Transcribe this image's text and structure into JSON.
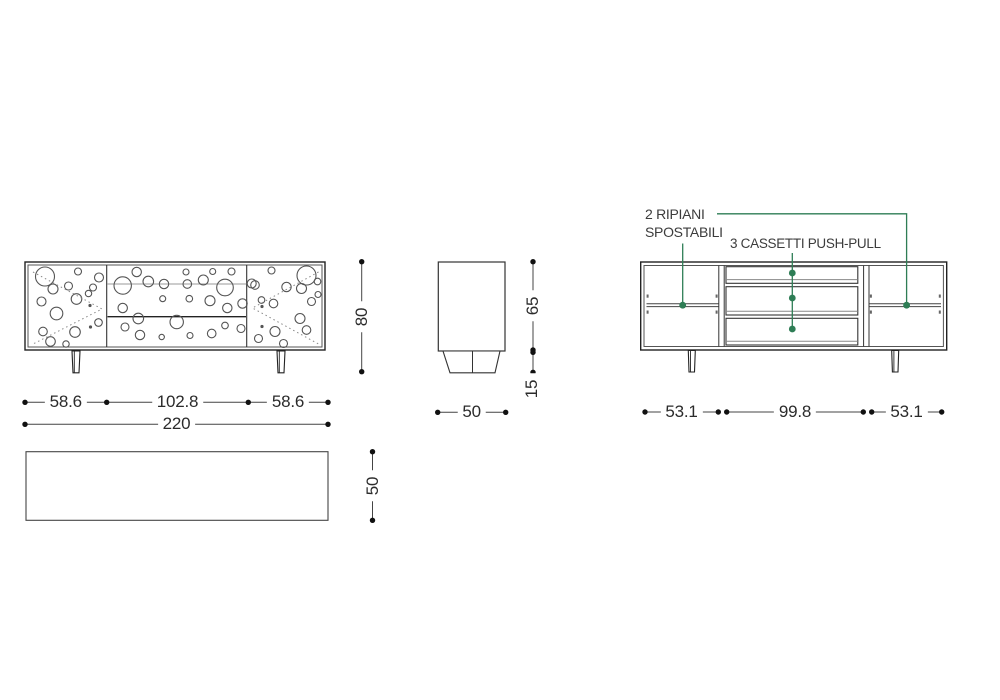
{
  "drawing": {
    "title": "sideboard-technical-drawing",
    "views": {
      "front": "front-view-with-perforated-doors",
      "side": "side-profile-view",
      "plan": "top-plan-view",
      "interior": "interior-front-view"
    }
  },
  "dimensions": {
    "front_width_segments": [
      "58.6",
      "102.8",
      "58.6"
    ],
    "front_width_total": "220",
    "height_total": "80",
    "body_height": "65",
    "leg_height": "15",
    "side_depth": "50",
    "plan_depth": "50",
    "interior_segments": [
      "53.1",
      "99.8",
      "53.1"
    ]
  },
  "annotations": {
    "shelves_label_line1": "2 RIPIANI",
    "shelves_label_line2": "SPOSTABILI",
    "drawers_label": "3 CASSETTI PUSH-PULL",
    "accent_color": "#2e7d55",
    "line_color": "#2b2b2b"
  },
  "decor": {
    "left_door_circles": [
      [
        45,
        276.5,
        9.5
      ],
      [
        78,
        271.5,
        3.5
      ],
      [
        53,
        289,
        5
      ],
      [
        68.5,
        286,
        4
      ],
      [
        99,
        277.5,
        4.5
      ],
      [
        93,
        287.5,
        3.5
      ],
      [
        41.5,
        301.5,
        4.5
      ],
      [
        76.5,
        299,
        5.3
      ],
      [
        88.5,
        293.5,
        3.2
      ],
      [
        56.5,
        313.5,
        6.3
      ],
      [
        43,
        331.5,
        4.3
      ],
      [
        75,
        332,
        5.3
      ],
      [
        50.5,
        341.5,
        4.8
      ],
      [
        98.5,
        322.5,
        3.8
      ],
      [
        66,
        344,
        3.2
      ]
    ],
    "drawer_front_circles": [
      [
        136.7,
        272,
        4.7
      ],
      [
        122.7,
        285.5,
        8.7
      ],
      [
        148.3,
        281.5,
        5.3
      ],
      [
        164,
        284,
        4.7
      ],
      [
        186,
        272,
        3
      ],
      [
        187.3,
        284,
        4.3
      ],
      [
        203.3,
        280,
        5
      ],
      [
        212.7,
        271.5,
        3
      ],
      [
        225,
        287.5,
        8.3
      ],
      [
        162.7,
        298.7,
        3
      ],
      [
        189.3,
        298.7,
        3.3
      ],
      [
        210,
        300.7,
        5
      ],
      [
        227.3,
        308,
        4.7
      ],
      [
        122.7,
        308,
        4.7
      ],
      [
        138.3,
        318.5,
        5.3
      ],
      [
        176.7,
        322,
        6.7
      ],
      [
        125,
        327,
        4
      ],
      [
        140,
        335,
        4.7
      ],
      [
        161.7,
        337,
        2.7
      ],
      [
        190,
        335.5,
        3
      ],
      [
        211.7,
        333.5,
        4.3
      ],
      [
        225,
        325.5,
        3.3
      ],
      [
        242.5,
        303.5,
        4.7
      ],
      [
        241,
        328.5,
        4
      ],
      [
        231.5,
        271.5,
        3.5
      ]
    ],
    "right_door_circles": [
      [
        306.5,
        275.5,
        9.5
      ],
      [
        271.5,
        270.5,
        3.5
      ],
      [
        286.5,
        287,
        4.7
      ],
      [
        301.5,
        288.5,
        5
      ],
      [
        317.5,
        281.5,
        3.3
      ],
      [
        255,
        285,
        4.3
      ],
      [
        261.5,
        300,
        3.3
      ],
      [
        273.5,
        303.5,
        4.3
      ],
      [
        311.5,
        301.5,
        4
      ],
      [
        300,
        318.5,
        5
      ],
      [
        258.5,
        338.5,
        4
      ],
      [
        275,
        331.5,
        5
      ],
      [
        283.5,
        343.5,
        4
      ],
      [
        306.5,
        330,
        4.3
      ],
      [
        318,
        294.5,
        3
      ],
      [
        251.7,
        283.5,
        4.5
      ]
    ],
    "tiny_filled_dots": [
      [
        90,
        305.5,
        1.6
      ],
      [
        90.5,
        327,
        1.6
      ],
      [
        262,
        306.5,
        1.6
      ],
      [
        262,
        326.5,
        1.6
      ]
    ]
  }
}
